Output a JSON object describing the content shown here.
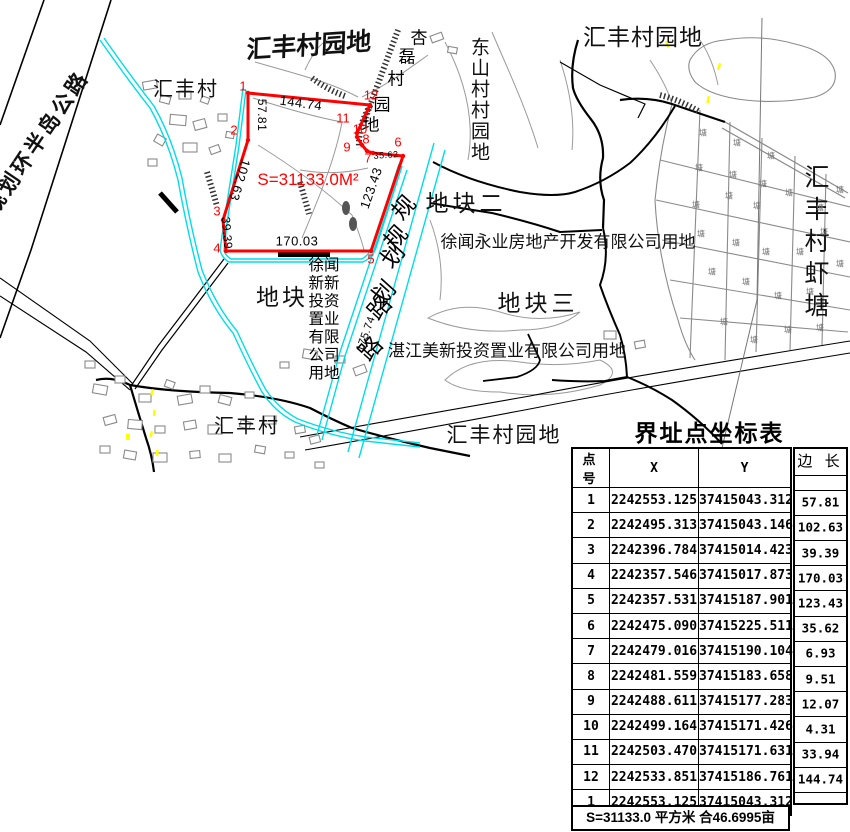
{
  "map": {
    "labels": {
      "planned_highway": "规划环半岛公路",
      "huifeng_village_nw": "汇丰村",
      "huifeng_garden_top": "汇丰村园地",
      "huifeng_garden_ne": "汇丰村园地",
      "dongshan_garden": "东山村村园地",
      "plot2": "地块二",
      "xuwen_yongye": "徐闻永业房地产开发有限公司用地",
      "plot3": "地块三",
      "zhanjiang_meixin": "湛江美新投资置业有限公司用地",
      "plot_left": "地块",
      "huifeng_village_s": "汇丰村",
      "huifeng_garden_s": "汇丰村园地",
      "shrimp_pond": "汇丰村虾塘",
      "area_text": "S=31133.0M²"
    },
    "xinxin_block": [
      "徐闻",
      "新新",
      "投资",
      "置业",
      "有限",
      "公司",
      "用地"
    ],
    "char_labels": [
      {
        "text": "杏磊村园地",
        "size": 17,
        "rot": 0,
        "pos": [
          [
            419,
            36
          ],
          [
            407,
            55
          ],
          [
            396,
            77
          ],
          [
            382,
            103
          ],
          [
            371,
            123
          ]
        ]
      },
      {
        "text": "规划路",
        "size": 23,
        "rot": -48,
        "pos": [
          [
            402,
            206
          ],
          [
            391,
            254
          ],
          [
            378,
            306
          ]
        ]
      },
      {
        "text": "规划路",
        "size": 23,
        "rot": -48,
        "pos": [
          [
            394,
            236
          ],
          [
            382,
            291
          ],
          [
            369,
            347
          ]
        ]
      }
    ],
    "pond_marks": {
      "char": "塘",
      "pos": [
        [
          703,
          133
        ],
        [
          737,
          143
        ],
        [
          771,
          156
        ],
        [
          699,
          168
        ],
        [
          733,
          175
        ],
        [
          763,
          184
        ],
        [
          729,
          196
        ],
        [
          696,
          205
        ],
        [
          757,
          206
        ],
        [
          789,
          193
        ],
        [
          820,
          208
        ],
        [
          840,
          190
        ],
        [
          701,
          234
        ],
        [
          736,
          243
        ],
        [
          766,
          252
        ],
        [
          800,
          252
        ],
        [
          824,
          232
        ],
        [
          712,
          272
        ],
        [
          746,
          282
        ],
        [
          778,
          296
        ],
        [
          810,
          292
        ],
        [
          840,
          264
        ],
        [
          724,
          322
        ],
        [
          754,
          340
        ],
        [
          788,
          330
        ],
        [
          820,
          328
        ]
      ]
    },
    "vertex_labels": [
      {
        "n": "1",
        "x": 243,
        "y": 86
      },
      {
        "n": "2",
        "x": 234,
        "y": 130
      },
      {
        "n": "3",
        "x": 217,
        "y": 211
      },
      {
        "n": "4",
        "x": 217,
        "y": 248
      },
      {
        "n": "5",
        "x": 371,
        "y": 259
      },
      {
        "n": "6",
        "x": 398,
        "y": 142
      },
      {
        "n": "7",
        "x": 368,
        "y": 158
      },
      {
        "n": "8",
        "x": 366,
        "y": 139
      },
      {
        "n": "9",
        "x": 347,
        "y": 147
      },
      {
        "n": "10",
        "x": 360,
        "y": 129
      },
      {
        "n": "11",
        "x": 343,
        "y": 118
      },
      {
        "n": "12",
        "x": 371,
        "y": 95
      }
    ],
    "edge_labels": [
      {
        "v": "57.81",
        "x": 262,
        "y": 115,
        "rot": 90,
        "s": 12
      },
      {
        "v": "144.74",
        "x": 301,
        "y": 103,
        "rot": 8,
        "s": 13
      },
      {
        "v": "102.63",
        "x": 240,
        "y": 180,
        "rot": 107,
        "s": 13
      },
      {
        "v": "39.39",
        "x": 227,
        "y": 233,
        "rot": 85,
        "s": 12
      },
      {
        "v": "170.03",
        "x": 297,
        "y": 241,
        "rot": 0,
        "s": 13
      },
      {
        "v": "123.43",
        "x": 371,
        "y": 188,
        "rot": -71,
        "s": 13
      },
      {
        "v": "35.62",
        "x": 386,
        "y": 155,
        "rot": -4,
        "s": 9
      },
      {
        "v": "175.74",
        "x": 366,
        "y": 334,
        "rot": -70,
        "s": 11
      }
    ],
    "boundary_screen_points": "248,93 248,140 223,220 226,251 371,251 403,156 373,153 367,151 362,145 357,137 357,133 370,105",
    "colors": {
      "boundary": "#ff0000",
      "water": "#00dde8",
      "marker": "#ffff00",
      "map_gray": "#999999"
    }
  },
  "table": {
    "title": "界址点坐标表",
    "headers": [
      "点 号",
      "X",
      "Y",
      "边 长"
    ],
    "points": [
      [
        "1",
        "2242553.125",
        "37415043.312"
      ],
      [
        "2",
        "2242495.313",
        "37415043.146"
      ],
      [
        "3",
        "2242396.784",
        "37415014.423"
      ],
      [
        "4",
        "2242357.546",
        "37415017.873"
      ],
      [
        "5",
        "2242357.531",
        "37415187.901"
      ],
      [
        "6",
        "2242475.090",
        "37415225.511"
      ],
      [
        "7",
        "2242479.016",
        "37415190.104"
      ],
      [
        "8",
        "2242481.559",
        "37415183.658"
      ],
      [
        "9",
        "2242488.611",
        "37415177.283"
      ],
      [
        "10",
        "2242499.164",
        "37415171.426"
      ],
      [
        "11",
        "2242503.470",
        "37415171.631"
      ],
      [
        "12",
        "2242533.851",
        "37415186.761"
      ],
      [
        "1",
        "2242553.125",
        "37415043.312"
      ]
    ],
    "edge_lengths": [
      "57.81",
      "102.63",
      "39.39",
      "170.03",
      "123.43",
      "35.62",
      "6.93",
      "9.51",
      "12.07",
      "4.31",
      "33.94",
      "144.74"
    ],
    "footer": "S=31133.0 平方米 合46.6995亩"
  }
}
